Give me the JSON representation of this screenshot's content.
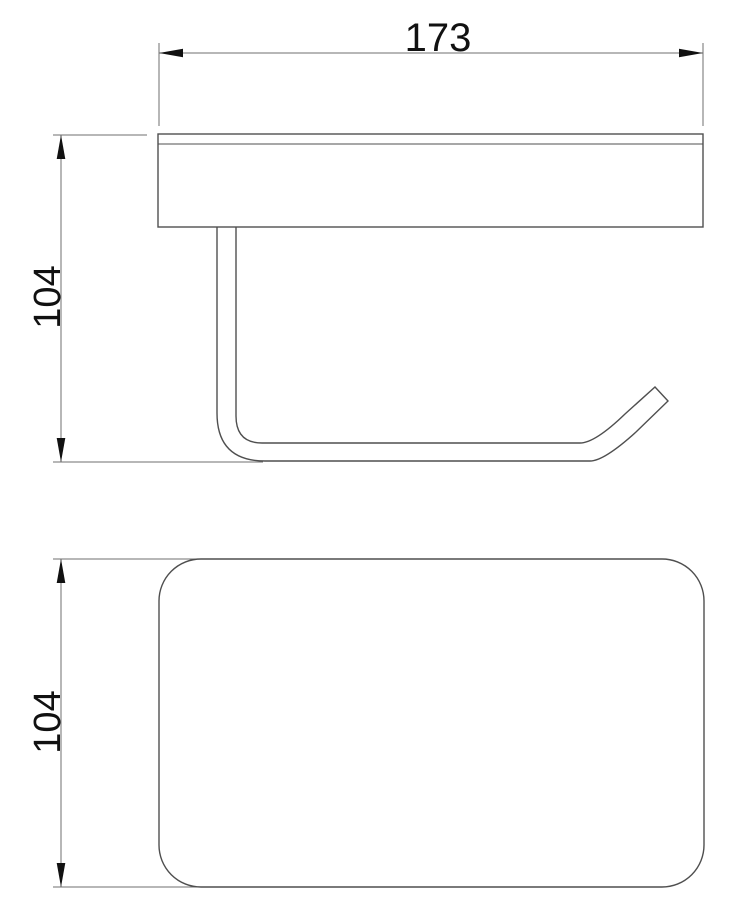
{
  "drawing": {
    "type": "technical-dimension-drawing",
    "subject": "wall-mounted toilet paper holder with shelf, two orthographic views",
    "front_view": {
      "width_dimension": {
        "value": "173"
      },
      "height_dimension": {
        "value": "104"
      }
    },
    "top_view": {
      "depth_dimension": {
        "value": "104"
      }
    },
    "colors": {
      "background": "#ffffff",
      "object_line": "#4f4f4f",
      "dimension_line": "#6f6f6f",
      "arrow": "#111111",
      "text": "#111111"
    }
  }
}
